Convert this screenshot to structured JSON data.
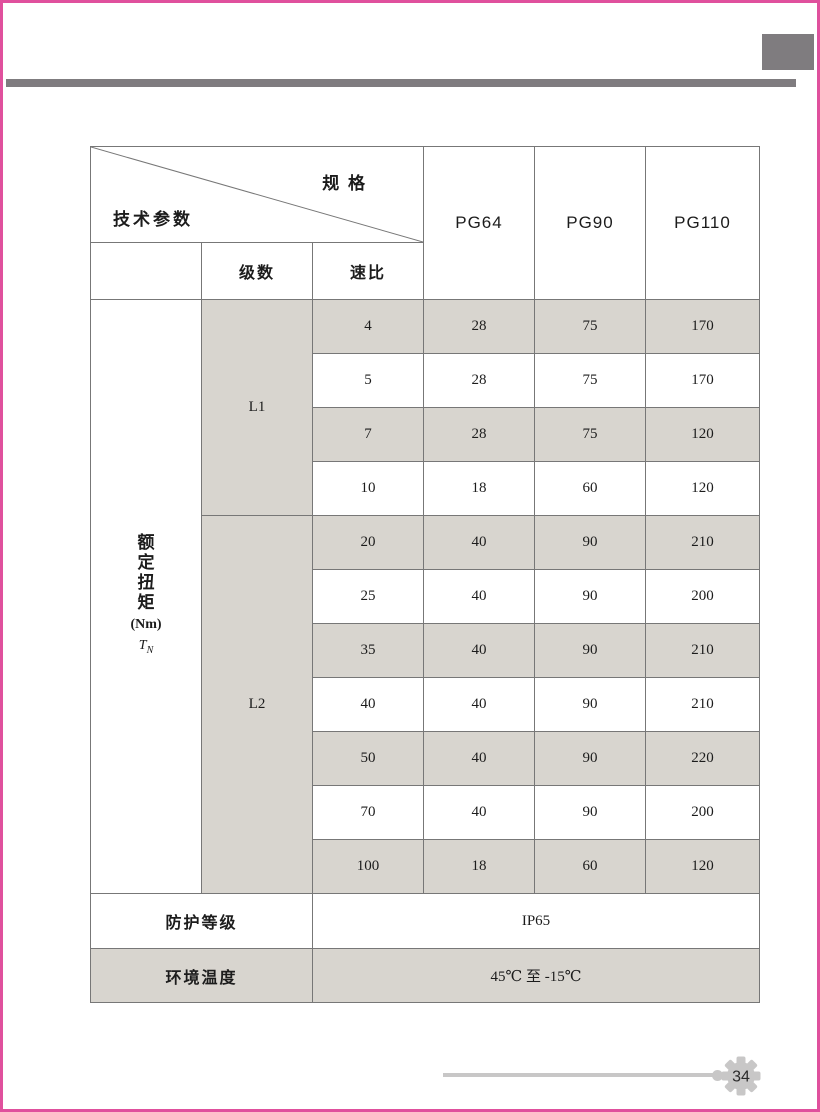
{
  "page": {
    "number": "34"
  },
  "decor": {
    "border_color": "#e0509d",
    "gray_accent": "#7f7c7f",
    "shade_color": "#d8d5cf",
    "gear_color": "#c8c7c7"
  },
  "table": {
    "corner": {
      "spec_label": "规 格",
      "param_label": "技术参数"
    },
    "subheader": {
      "stage": "级数",
      "ratio": "速比"
    },
    "models": [
      "PG64",
      "PG90",
      "PG110"
    ],
    "torque_label": {
      "chars": [
        "额",
        "定",
        "扭",
        "矩"
      ],
      "unit": "(Nm)",
      "sym": "T",
      "sym_sub": "N"
    },
    "groups": [
      {
        "stage": "L1",
        "rows": [
          {
            "ratio": "4",
            "v64": "28",
            "v90": "75",
            "v110": "170"
          },
          {
            "ratio": "5",
            "v64": "28",
            "v90": "75",
            "v110": "170"
          },
          {
            "ratio": "7",
            "v64": "28",
            "v90": "75",
            "v110": "120"
          },
          {
            "ratio": "10",
            "v64": "18",
            "v90": "60",
            "v110": "120"
          }
        ]
      },
      {
        "stage": "L2",
        "rows": [
          {
            "ratio": "20",
            "v64": "40",
            "v90": "90",
            "v110": "210"
          },
          {
            "ratio": "25",
            "v64": "40",
            "v90": "90",
            "v110": "200"
          },
          {
            "ratio": "35",
            "v64": "40",
            "v90": "90",
            "v110": "210"
          },
          {
            "ratio": "40",
            "v64": "40",
            "v90": "90",
            "v110": "210"
          },
          {
            "ratio": "50",
            "v64": "40",
            "v90": "90",
            "v110": "220"
          },
          {
            "ratio": "70",
            "v64": "40",
            "v90": "90",
            "v110": "200"
          },
          {
            "ratio": "100",
            "v64": "18",
            "v90": "60",
            "v110": "120"
          }
        ]
      }
    ],
    "footer": [
      {
        "label": "防护等级",
        "value": "IP65"
      },
      {
        "label": "环境温度",
        "value": "45℃ 至 -15℃"
      }
    ]
  }
}
